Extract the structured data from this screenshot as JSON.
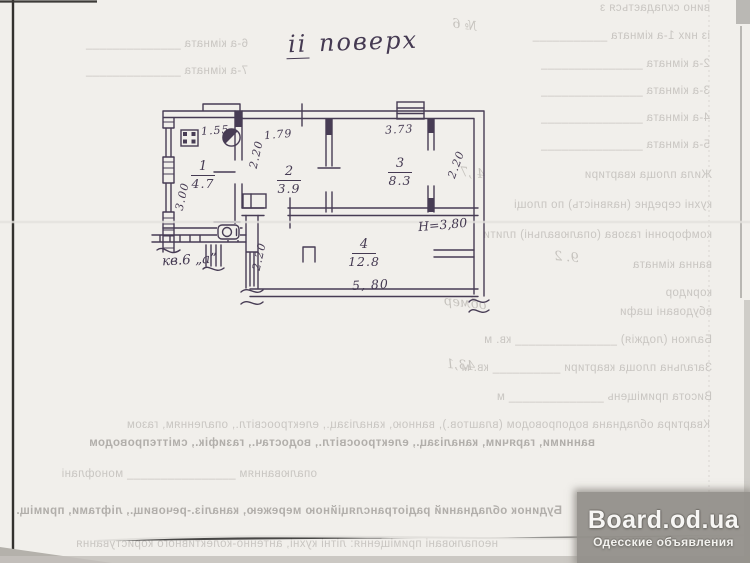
{
  "colors": {
    "paper": "#f1efeb",
    "ink": "#473c54",
    "bleed_text": "#c9c6c2",
    "scanner_shadow": "#94918b"
  },
  "plan": {
    "title_roman": "ii",
    "title_word": "поверх",
    "apartment": "кв.6 „а”",
    "height_note": "Н=3,80",
    "rooms": [
      {
        "num": "1",
        "area": "4.7"
      },
      {
        "num": "2",
        "area": "3.9"
      },
      {
        "num": "3",
        "area": "8.3"
      },
      {
        "num": "4",
        "area": "12.8"
      }
    ],
    "dims": {
      "d155": "1.55",
      "d179": "1.79",
      "d373": "3.73",
      "d300": "3.00",
      "d220_room2": "2.20",
      "d220_strip": "2.20",
      "d220_room4": "2.20",
      "d580": "5, 80"
    },
    "fixtures": [
      "stove",
      "sink",
      "toilet"
    ]
  },
  "bleed_lines": [
    {
      "x": 488,
      "y": 2,
      "w": 222,
      "b": 0,
      "t": "вино складається з"
    },
    {
      "x": 468,
      "y": 30,
      "w": 242,
      "b": 0,
      "t": "із них 1-а кімната ___________"
    },
    {
      "x": 478,
      "y": 58,
      "w": 232,
      "b": 0,
      "t": "2-а кімната _______________"
    },
    {
      "x": 478,
      "y": 85,
      "w": 232,
      "b": 0,
      "t": "3-а кімната _______________"
    },
    {
      "x": 478,
      "y": 112,
      "w": 232,
      "b": 0,
      "t": "4-а кімната _______________"
    },
    {
      "x": 478,
      "y": 139,
      "w": 232,
      "b": 0,
      "t": "5-а кімната _______________"
    },
    {
      "x": 468,
      "y": 169,
      "w": 244,
      "b": 0,
      "t": "Жила площа квартири"
    },
    {
      "x": 452,
      "y": 199,
      "w": 260,
      "b": 0,
      "t": "кухні середнє (наявність) по площі"
    },
    {
      "x": 438,
      "y": 229,
      "w": 274,
      "b": 0,
      "t": "комфоронні газова (опалювальні) плити"
    },
    {
      "x": 470,
      "y": 259,
      "w": 242,
      "b": 0,
      "t": "ванна кімната"
    },
    {
      "x": 562,
      "y": 287,
      "w": 150,
      "b": 0,
      "t": "коридор"
    },
    {
      "x": 544,
      "y": 306,
      "w": 168,
      "b": 0,
      "t": "вбудовані шафи"
    },
    {
      "x": 336,
      "y": 334,
      "w": 376,
      "b": 0,
      "t": "Балкон (лоджія) _______________ кв. м"
    },
    {
      "x": 330,
      "y": 362,
      "w": 382,
      "b": 0,
      "t": "Загальна площа квартири __________ кв. м"
    },
    {
      "x": 336,
      "y": 391,
      "w": 376,
      "b": 0,
      "t": "Висота приміщень ______________ м"
    },
    {
      "x": 42,
      "y": 419,
      "w": 668,
      "b": 0,
      "t": "Квартира обладнана водопроводом (влаштов.), ванною, каналізац., електроосвітл., опаленням, газом"
    },
    {
      "x": 30,
      "y": 437,
      "w": 565,
      "b": 1,
      "t": "ванними, гарячим, каналізац., електроосвітл., водостач., газифік., сміттєпроводом"
    },
    {
      "x": 32,
      "y": 468,
      "w": 285,
      "b": 0,
      "t": "опалюванням ________________ монофлані"
    },
    {
      "x": 0,
      "y": 505,
      "w": 562,
      "b": 1,
      "t": "Будинок обладнаний радіотрансляційною мережею, каналіз.-речовищ., ліфтами, приміщ."
    },
    {
      "x": 0,
      "y": 538,
      "w": 498,
      "b": 0,
      "t": "неопалювані приміщення: літні кухні, антенно-колективного користування"
    },
    {
      "x": 20,
      "y": 38,
      "w": 228,
      "b": 0,
      "t": "6-а кімната ______________"
    },
    {
      "x": 20,
      "y": 65,
      "w": 228,
      "b": 0,
      "t": "7-а кімната ______________"
    }
  ],
  "handwritten_marks": [
    {
      "x": 452,
      "y": 18,
      "r": -8,
      "t": "№ 6"
    },
    {
      "x": 460,
      "y": 166,
      "r": -6,
      "t": "4 ,7"
    },
    {
      "x": 554,
      "y": 250,
      "r": -5,
      "t": "9. 2"
    },
    {
      "x": 444,
      "y": 296,
      "r": -6,
      "t": "обмер"
    },
    {
      "x": 446,
      "y": 358,
      "r": -5,
      "t": "43,1"
    }
  ],
  "watermark": {
    "title": "Board.od.ua",
    "subtitle": "Одесские объявления"
  }
}
